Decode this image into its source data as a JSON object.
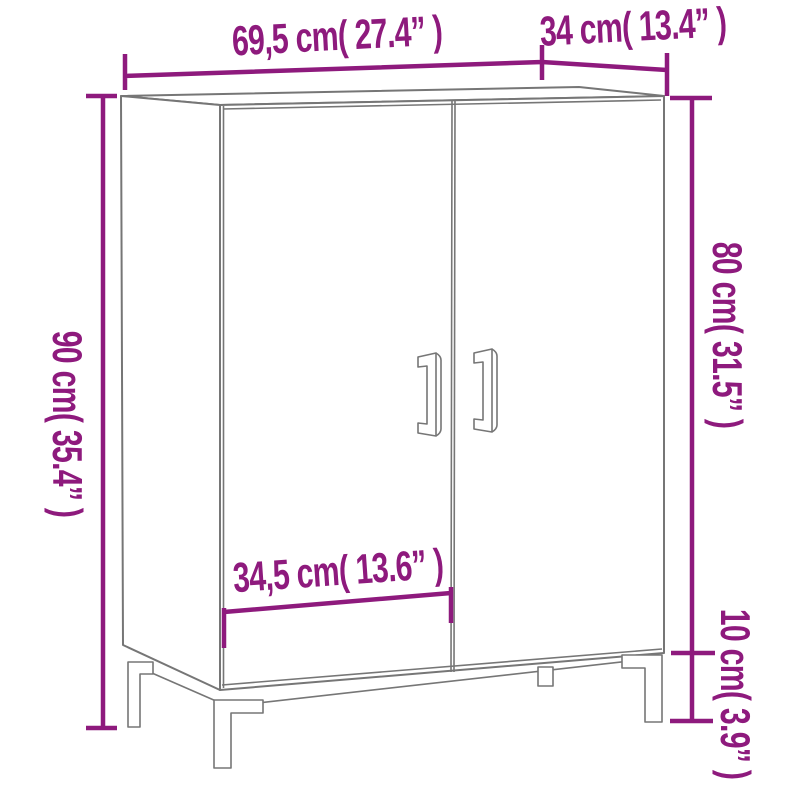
{
  "diagram": {
    "subject": "two-door cabinet dimension line drawing",
    "accent_color": "#8e1a7d",
    "line_color": "#767676",
    "labels": {
      "width": "69,5 cm( 27.4” )",
      "depth": "34 cm( 13.4” )",
      "total_height": "90 cm( 35.4” )",
      "body_height": "80 cm( 31.5” )",
      "leg_height": "10 cm( 3.9” )",
      "door_width": "34,5 cm( 13.6” )"
    },
    "measurements": {
      "width_cm": "69,5",
      "width_in": "27.4",
      "depth_cm": "34",
      "depth_in": "13.4",
      "total_height_cm": "90",
      "total_height_in": "35.4",
      "body_height_cm": "80",
      "body_height_in": "31.5",
      "leg_height_cm": "10",
      "leg_height_in": "3.9",
      "door_width_cm": "34,5",
      "door_width_in": "13.6"
    }
  }
}
